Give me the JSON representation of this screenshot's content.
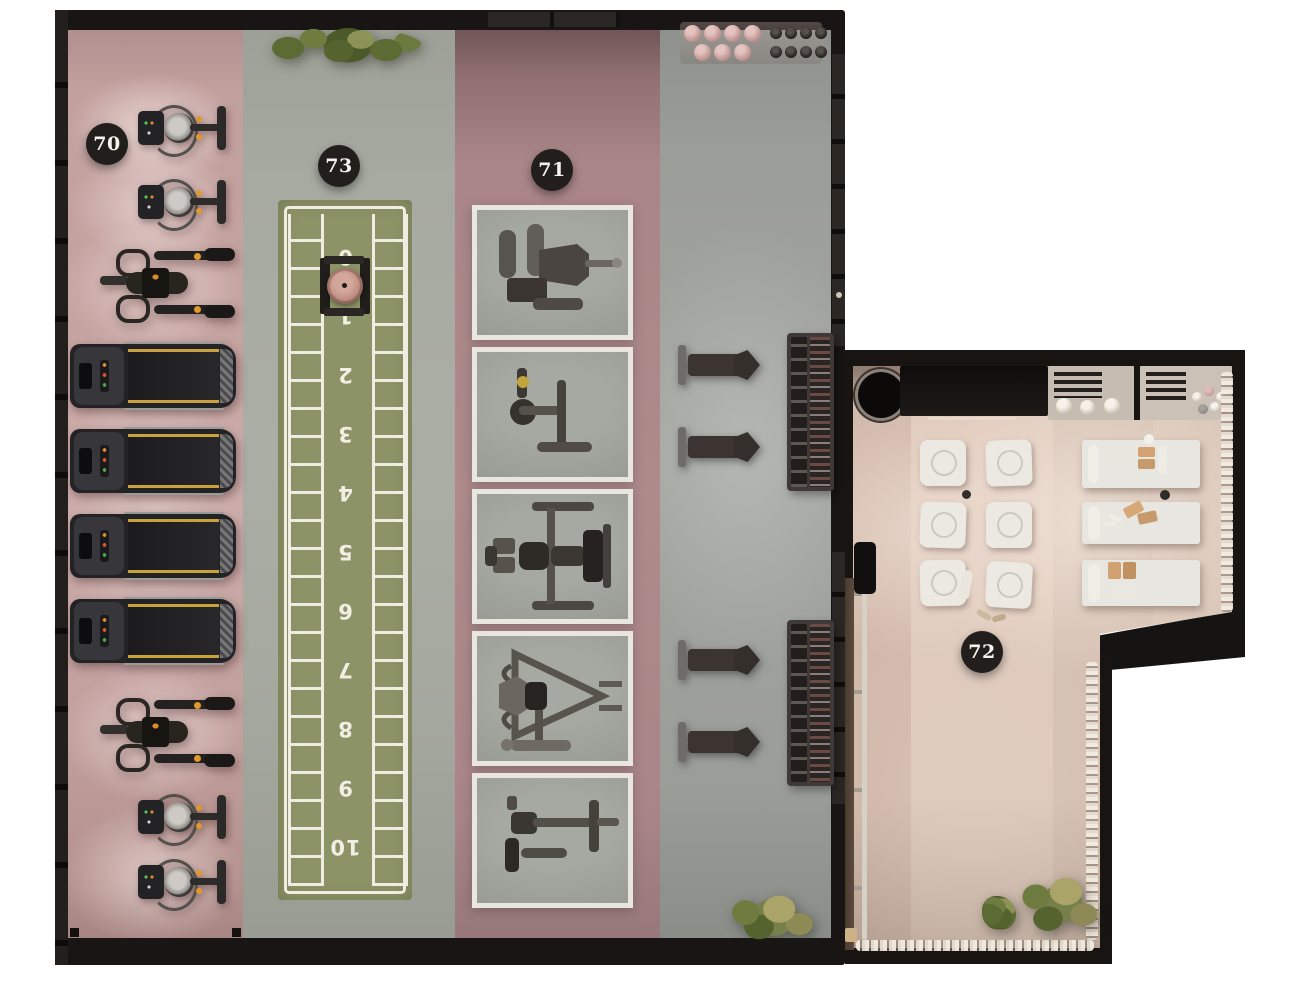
{
  "scene": {
    "type": "gym-floor-plan-top-view",
    "background": "#ffffff"
  },
  "badges": {
    "b70": {
      "label": "70",
      "zone": "cardio-strip"
    },
    "b73": {
      "label": "73",
      "zone": "sled-track"
    },
    "b71": {
      "label": "71",
      "zone": "machine-row"
    },
    "b72": {
      "label": "72",
      "zone": "recovery-studio"
    }
  },
  "track": {
    "numbers": [
      "0",
      "1",
      "2",
      "3",
      "4",
      "5",
      "6",
      "7",
      "8",
      "9",
      "10"
    ]
  },
  "palette": {
    "wall": "#181514",
    "floor_gray": "#a3a69e",
    "cardio_pink": "#c2a09e",
    "strength_pink": "#a98587",
    "track_green": "#8c9367",
    "court_line": "#efece1",
    "annex_floor": "#d6c2b4",
    "mat_white": "#ece9e2",
    "badge_bg": "#211e1c",
    "badge_text": "#f5f2ec",
    "equipment_dark": "#2b2826",
    "accent_yellow": "#c9a23b",
    "accent_orange": "#e0892d",
    "plant_green": "#5f6f3a",
    "prop_tan": "#d2a171"
  },
  "equipment": {
    "cardio_strip": [
      "exercise-bike",
      "exercise-bike",
      "elliptical-trainer",
      "treadmill",
      "treadmill",
      "treadmill",
      "treadmill",
      "elliptical-trainer",
      "exercise-bike",
      "exercise-bike"
    ],
    "sled_track": [
      "weight-sled"
    ],
    "machine_row": [
      "chest-press-machine",
      "seated-arm-machine",
      "dual-stack-press-machine",
      "incline-lever-machine",
      "seated-row-machine"
    ],
    "free_weight_area": [
      "flat-bench",
      "flat-bench",
      "dumbbell-rack",
      "flat-bench",
      "flat-bench",
      "dumbbell-rack",
      "medicine-ball-rack"
    ],
    "recovery_studio": [
      "exercise-mat",
      "exercise-mat",
      "exercise-mat",
      "exercise-mat",
      "exercise-mat",
      "exercise-mat",
      "massage-table",
      "massage-table",
      "massage-table",
      "wall-barre",
      "dumbbell-shelf",
      "accessory-shelf",
      "planter",
      "plant",
      "plant"
    ]
  }
}
